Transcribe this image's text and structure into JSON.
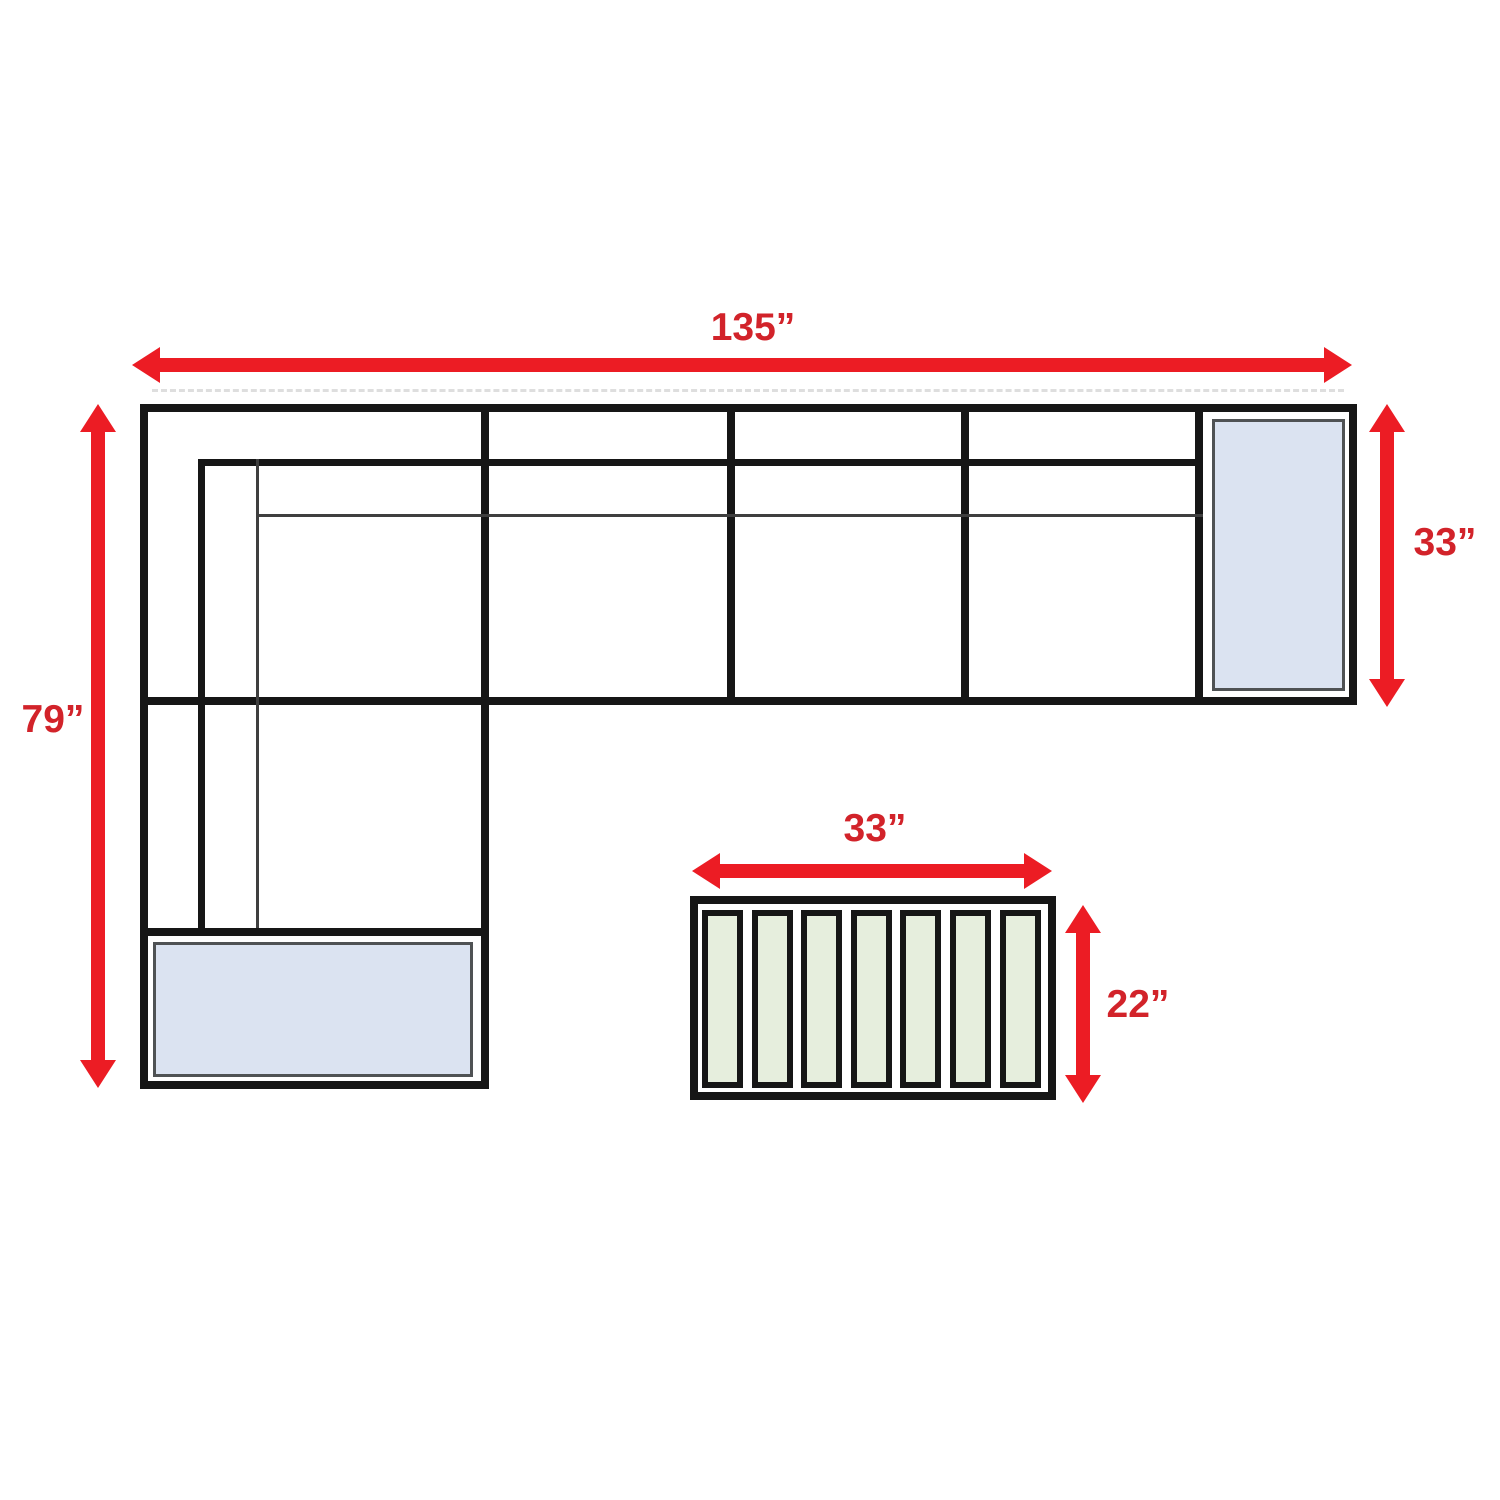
{
  "page": {
    "background": "#ffffff",
    "description": "Top-view dimension diagram of an L-shaped sectional sofa with chaise end cushion, ottoman cushion, and a slatted coffee table"
  },
  "labels": {
    "sofa_width": "135”",
    "sofa_depth": "79”",
    "end_section_depth": "33”",
    "table_width": "33”",
    "table_depth": "22”"
  },
  "colors": {
    "arrow_red": "#ec1c24",
    "label_red": "#d2232a",
    "line_black": "#161616",
    "thin_line_gray": "#3f3f3f",
    "cushion_blue": "#dbe3f1",
    "cushion_border_gray": "#4f5254",
    "slat_green": "#e6eedd"
  },
  "sofa": {
    "seat_sections": 4,
    "end_cushion_count": 1,
    "ottoman_cushion_count": 1
  },
  "table": {
    "slat_count": 7
  }
}
